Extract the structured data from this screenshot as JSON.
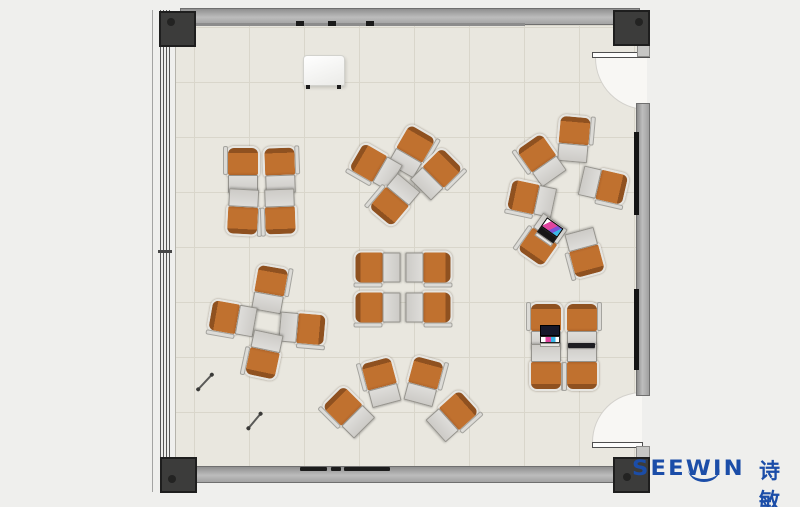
{
  "logo": {
    "brand": "SEEWIN",
    "cjk": "诗敏"
  },
  "colors": {
    "page-bg": "#efefed",
    "floor": "#e9e7df",
    "grid": "#d9d6cb",
    "wall-light": "#b7b7b7",
    "wall-dark": "#8e8e8e",
    "wall-border": "#6f6f6f",
    "post": "#3c3c3b",
    "post-border": "#1e1e1e",
    "chair": "#c0712f",
    "chair-back": "#8f5120",
    "chair-shell": "#e6e5e1",
    "desk": "#cdcbc7",
    "desk-border": "#95938d",
    "door": "#f8f7f4",
    "brand-blue": "#1b4da8",
    "screen-dark": "#15182a",
    "accent-pink": "#e0459f",
    "accent-cyan": "#39b7e8"
  },
  "plan": {
    "units": [
      {
        "cluster": "top-left",
        "x": 243,
        "y": 169,
        "r": 0,
        "f": 1
      },
      {
        "cluster": "top-left",
        "x": 280,
        "y": 169,
        "r": -2
      },
      {
        "cluster": "top-left",
        "x": 243,
        "y": 212,
        "r": 183,
        "f": 1
      },
      {
        "cluster": "top-left",
        "x": 280,
        "y": 212,
        "r": 178
      },
      {
        "cluster": "top-center",
        "x": 412,
        "y": 150,
        "r": 30
      },
      {
        "cluster": "top-center",
        "x": 437,
        "y": 173,
        "r": 45
      },
      {
        "cluster": "top-center",
        "x": 375,
        "y": 166,
        "r": -60,
        "f": 1
      },
      {
        "cluster": "top-center",
        "x": 394,
        "y": 200,
        "r": 220
      },
      {
        "cluster": "right-circle",
        "x": 574,
        "y": 138,
        "r": 5
      },
      {
        "cluster": "right-circle",
        "x": 541,
        "y": 159,
        "r": -35,
        "f": 1
      },
      {
        "cluster": "right-circle",
        "x": 531,
        "y": 198,
        "r": -78,
        "f": 1
      },
      {
        "cluster": "right-circle",
        "x": 542,
        "y": 240,
        "r": 215
      },
      {
        "cluster": "right-circle",
        "x": 585,
        "y": 253,
        "r": 165
      },
      {
        "cluster": "right-circle",
        "x": 604,
        "y": 185,
        "r": 103
      },
      {
        "cluster": "center",
        "x": 377,
        "y": 267,
        "r": -90,
        "f": 1
      },
      {
        "cluster": "center",
        "x": 429,
        "y": 267,
        "r": 90
      },
      {
        "cluster": "center",
        "x": 377,
        "y": 307,
        "r": -90,
        "f": 1
      },
      {
        "cluster": "center",
        "x": 429,
        "y": 307,
        "r": 90
      },
      {
        "cluster": "left-pinwheel",
        "x": 270,
        "y": 288,
        "r": 10
      },
      {
        "cluster": "left-pinwheel",
        "x": 232,
        "y": 318,
        "r": -80,
        "f": 1
      },
      {
        "cluster": "left-pinwheel",
        "x": 303,
        "y": 328,
        "r": 95
      },
      {
        "cluster": "left-pinwheel",
        "x": 264,
        "y": 355,
        "r": 192
      },
      {
        "cluster": "bottom-fan",
        "x": 348,
        "y": 411,
        "r": -45,
        "f": 1
      },
      {
        "cluster": "bottom-fan",
        "x": 381,
        "y": 381,
        "r": -15,
        "f": 1
      },
      {
        "cluster": "bottom-fan",
        "x": 424,
        "y": 380,
        "r": 15
      },
      {
        "cluster": "bottom-fan",
        "x": 453,
        "y": 415,
        "r": 48
      },
      {
        "cluster": "bottom-right",
        "x": 546,
        "y": 325,
        "r": 0,
        "f": 1
      },
      {
        "cluster": "bottom-right",
        "x": 582,
        "y": 325,
        "r": 0
      },
      {
        "cluster": "bottom-right",
        "x": 546,
        "y": 367,
        "r": 180,
        "f": 1
      },
      {
        "cluster": "bottom-right",
        "x": 582,
        "y": 367,
        "r": 180
      }
    ],
    "laptops": [
      {
        "x": 549,
        "y": 232,
        "r": 35,
        "variant": "color-top"
      },
      {
        "x": 550,
        "y": 336,
        "r": 0,
        "variant": "dark-top"
      }
    ],
    "tablet": {
      "x": 568,
      "y": 343,
      "w": 27,
      "h": 5
    },
    "pens": [
      {
        "x": 205,
        "y": 381,
        "r": -47,
        "len": 20
      },
      {
        "x": 254,
        "y": 420,
        "r": -50,
        "len": 19
      }
    ]
  }
}
